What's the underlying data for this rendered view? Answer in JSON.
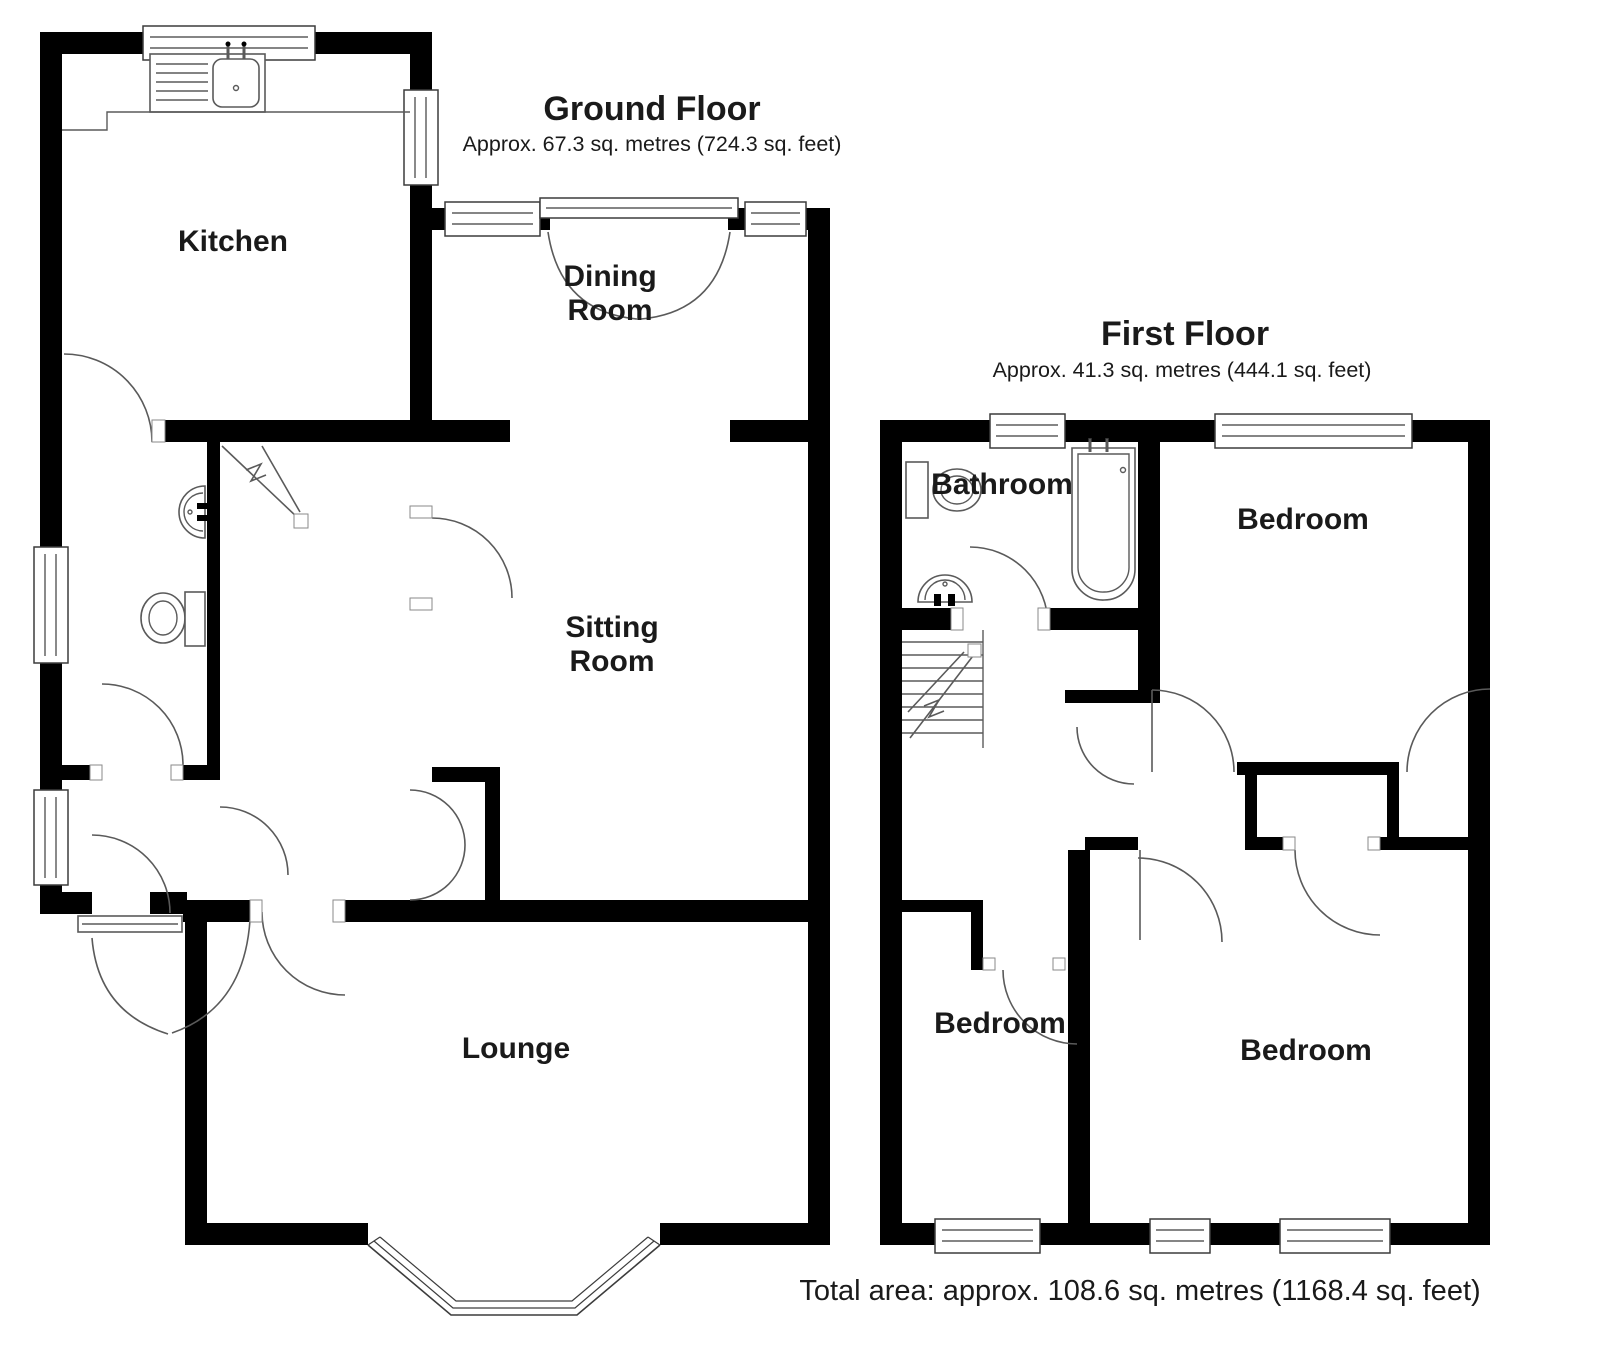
{
  "ground_floor": {
    "title": "Ground Floor",
    "area": "Approx. 67.3 sq. metres (724.3 sq. feet)",
    "rooms": {
      "kitchen": "Kitchen",
      "dining_line1": "Dining",
      "dining_line2": "Room",
      "sitting_line1": "Sitting",
      "sitting_line2": "Room",
      "lounge": "Lounge"
    }
  },
  "first_floor": {
    "title": "First Floor",
    "area": "Approx. 41.3 sq. metres (444.1 sq. feet)",
    "rooms": {
      "bathroom": "Bathroom",
      "bedroom_top": "Bedroom",
      "bedroom_bottom_left": "Bedroom",
      "bedroom_bottom_right": "Bedroom"
    }
  },
  "footer": {
    "total_area": "Total area: approx. 108.6 sq. metres (1168.4 sq. feet)"
  },
  "colors": {
    "wall": "#000000",
    "detail_line": "#5a5a5a",
    "background": "#ffffff"
  }
}
